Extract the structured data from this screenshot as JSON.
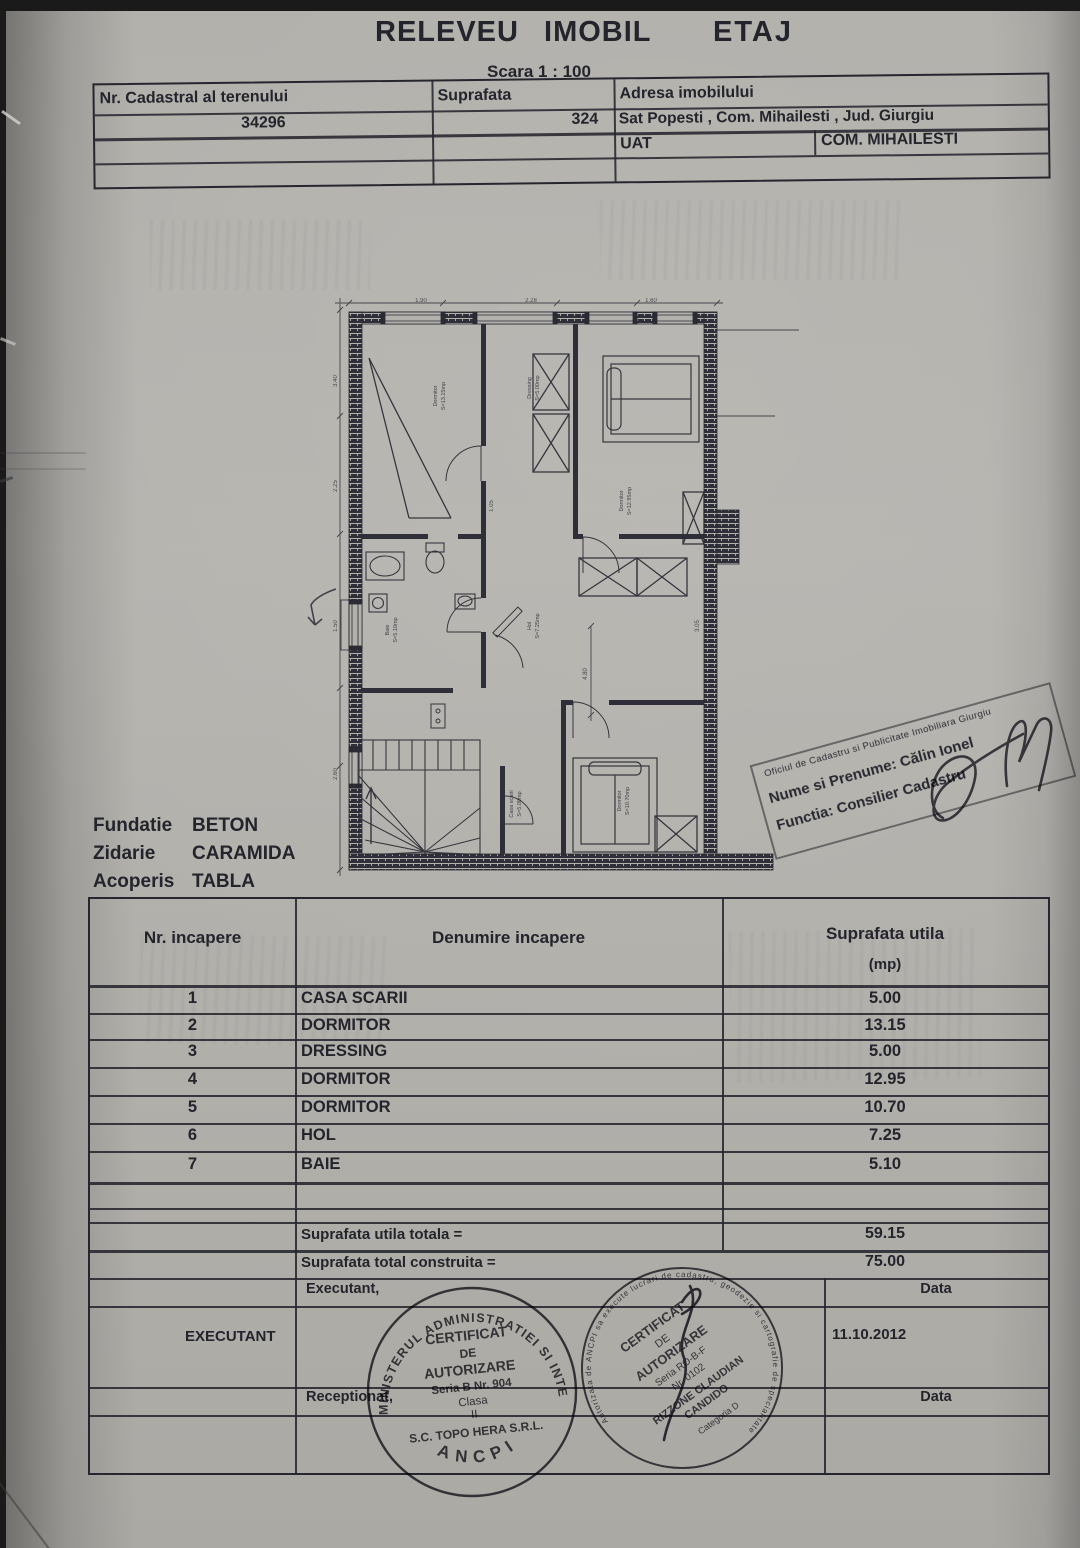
{
  "page": {
    "title_main": "RELEVEU IMOBIL",
    "title_floor": "ETAJ",
    "scale_label": "Scara 1 : 100"
  },
  "parcel_table": {
    "cadastral_header": "Nr. Cadastral al terenului",
    "suprafata_header": "Suprafata",
    "adresa_header": "Adresa imobilului",
    "cadastral_value": "34296",
    "suprafata_value": "324",
    "adresa_value": "Sat Popesti , Com. Mihailesti , Jud. Giurgiu",
    "uat_label": "UAT",
    "uat_value": "COM. MIHAILESTI"
  },
  "construction": {
    "rows": [
      {
        "label": "Fundatie",
        "value": "BETON"
      },
      {
        "label": "Zidarie",
        "value": "CARAMIDA"
      },
      {
        "label": "Acoperis",
        "value": "TABLA"
      }
    ]
  },
  "ocpi_stamp": {
    "office_line": "Oficiul de Cadastru si Publicitate Imobiliara Giurgiu",
    "name_line": "Nume si Prenume: Călin Ionel",
    "function_line": "Functia: Consilier Cadastru"
  },
  "rooms_table": {
    "nr_header": "Nr. incapere",
    "denumire_header": "Denumire incapere",
    "suprafata_header": "Suprafata utila",
    "suprafata_unit": "(mp)",
    "rows": [
      {
        "nr": "1",
        "name": "CASA SCARII",
        "area": "5.00"
      },
      {
        "nr": "2",
        "name": "DORMITOR",
        "area": "13.15"
      },
      {
        "nr": "3",
        "name": "DRESSING",
        "area": "5.00"
      },
      {
        "nr": "4",
        "name": "DORMITOR",
        "area": "12.95"
      },
      {
        "nr": "5",
        "name": "DORMITOR",
        "area": "10.70"
      },
      {
        "nr": "6",
        "name": "HOL",
        "area": "7.25"
      },
      {
        "nr": "7",
        "name": "BAIE",
        "area": "5.10"
      }
    ],
    "total_utila_label": "Suprafata utila totala =",
    "total_utila_value": "59.15",
    "total_construita_label": "Suprafata total construita =",
    "total_construita_value": "75.00"
  },
  "signoff": {
    "executant_label": "Executant,",
    "executant_name": "EXECUTANT",
    "data_label_top": "Data",
    "date_value": "11.10.2012",
    "receptionat_label": "Receptionat,",
    "data_label_bottom": "Data"
  },
  "round_stamp_left": {
    "ring_top": "MINISTERUL ADMINISTRATIEI SI INTERNELOR",
    "ring_bottom": "ANCPI",
    "line1": "CERTIFICAT",
    "line2": "DE",
    "line3": "AUTORIZARE",
    "line4": "Seria B Nr. 904",
    "line5": "Clasa",
    "line6": "II",
    "line7": "S.C. TOPO HERA S.R.L."
  },
  "round_stamp_right": {
    "ring_text": "Autorizata de ANCPI sa execute lucrari de cadastru, geodezie si cartografie de specialitate",
    "line1": "CERTIFICAT",
    "line2": "DE",
    "line3": "AUTORIZARE",
    "line4": "Seria RO-B-F",
    "line5": "Nr. 0102",
    "line6": "RIZZONE CLAUDIAN",
    "line7": "CANDIDO",
    "line8": "Categoria D"
  },
  "floor_plan": {
    "rooms": {
      "dormitor_tl": {
        "name": "Dormitor",
        "area": "S=13.15mp"
      },
      "dressing": {
        "name": "Dressing",
        "area": "S=5.00mp"
      },
      "dormitor_tr": {
        "name": "Dormitor",
        "area": "S=12.95mp"
      },
      "baie": {
        "name": "Baie",
        "area": "S=5.10mp"
      },
      "hol": {
        "name": "Hol",
        "area": "S=7.25mp"
      },
      "dormitor_br": {
        "name": "Dormitor",
        "area": "S=10.70mp"
      },
      "casa_scarii": {
        "name": "Casa scarii",
        "area": "S=5.00mp"
      }
    },
    "dims": [
      "3.40",
      "2.25",
      "1.50",
      "2.60",
      "1.90",
      "2.28",
      "1.60",
      "4.80",
      "3.05",
      "1.05"
    ]
  }
}
